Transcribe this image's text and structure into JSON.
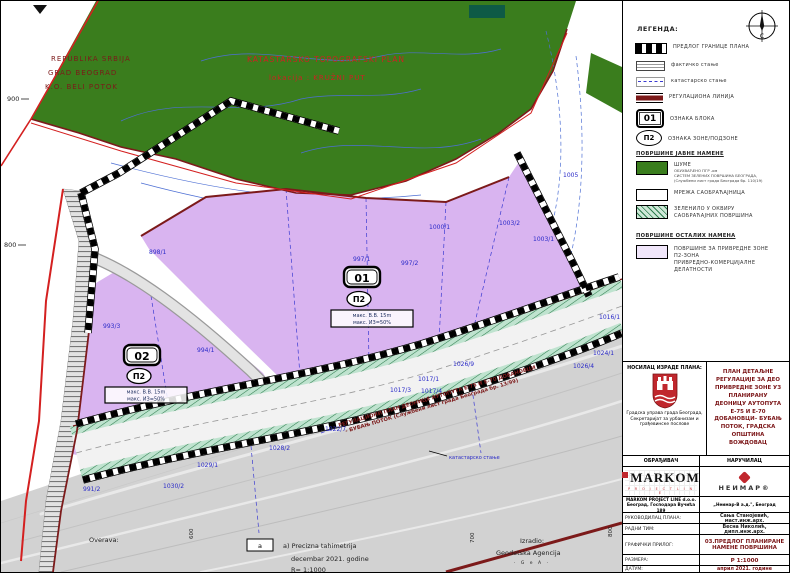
{
  "colors": {
    "forest_green": "#3a7d1d",
    "zone_purple": "#d9b4f0",
    "strip_green": "#6fbe8e",
    "regulation_maroon": "#7c1a1a",
    "boundary_red": "#d42020",
    "cadastral_blue": "#3b3bd1",
    "road_gray": "#d2d2d2"
  },
  "map": {
    "region": {
      "line1": "REPUBLIKA SRBIJA",
      "line2": "GRAD BEOGRAD",
      "line3": "K.O. BELI POTOK"
    },
    "title": {
      "line1": "KATASTARSKO TOPOGRAFSKI PLAN",
      "line2": "lokacija : KRUŽNI PUT"
    },
    "blocks": [
      {
        "id": "01",
        "zone": "П2",
        "param1": "макс. В.В. 15m",
        "param2": "макс. ИЗ=50%"
      },
      {
        "id": "02",
        "zone": "П2",
        "param1": "макс. В.В. 15m",
        "param2": "макс. ИЗ=50%"
      }
    ],
    "parcels": [
      "898/1",
      "997/1",
      "997/2",
      "1000/1",
      "1003/2",
      "1003/1",
      "1005",
      "1016/1",
      "1024/1",
      "1026/4",
      "1026/9",
      "1017/1",
      "1017/3",
      "1017/4",
      "1022/7",
      "1028/2",
      "1029/1",
      "1030/2",
      "993/3",
      "994/1",
      "991/2"
    ],
    "road_label_line1": "РЕГУЛАЦИОНИ ПЛАН ДЕОНИЦЕ АУТОПУТА Е-75 И Е-70 ДОБАНОВЦИ",
    "road_label_line2": "- БУБАЊ ПОТОК (Службени лист града Београда бр. 13/99)",
    "cadastral_note": "катастарско стање",
    "elevation_900": "900",
    "elevation_800": "800",
    "grid_600": "600",
    "grid_700": "700",
    "grid_800": "800",
    "overava": "Overava:",
    "izradio": "Izradio:",
    "agency": "Geodetska Agencija",
    "agency_sub": "· G e A ·",
    "survey_box": "a",
    "survey_line1": "a) Precizna tahimetrija",
    "survey_line2": "decembar 2021. godine",
    "survey_line3": "R= 1:1000"
  },
  "legend": {
    "title": "ЛЕГЕНДА:",
    "compass_letter": "С",
    "boundary": "ПРЕДЛОГ ГРАНИЦЕ ПЛАНА",
    "factual": "фактичко стање",
    "cadastral": "катастарско стање",
    "regulation": "РЕГУЛАЦИОНА ЛИНИЈА",
    "block_badge": "01",
    "block_label": "ОЗНАКА БЛОКА",
    "zone_badge": "П2",
    "zone_label": "ОЗНАКА ЗОНЕ/ПОДЗОНЕ",
    "section_public": "ПОВРШИНЕ ЈАВНЕ НАМЕНЕ",
    "forest": "ШУМЕ",
    "forest_note1": "ОБУХВАЋЕНО ПГР -ом",
    "forest_note2": "СИСТЕМ ЗЕЛЕНИХ ПОВРШИНА БЕОГРАДА,",
    "forest_note3": "(Службени лист града Београда бр. 110/19)",
    "roads": "МРЕЖА САОБРАЋАЈНИЦА",
    "greenery1": "ЗЕЛЕНИЛО У ОКВИРУ",
    "greenery2": "САОБРАЋАЈНИХ ПОВРШИНА",
    "section_other": "ПОВРШИНЕ ОСТАЛИХ НАМЕНА",
    "economic1": "ПОВРШИНЕ ЗА ПРИВРЕДНЕ ЗОНЕ",
    "economic2": "П2-ЗОНА",
    "economic3": "ПРИВРЕДНО-КОМЕРЦИЈАЛНЕ",
    "economic4": "ДЕЛАТНОСТИ"
  },
  "titleblock": {
    "holder_label": "НОСИЛАЦ ИЗРАДЕ ПЛАНА:",
    "holder_org1": "Градска управа града Београда,",
    "holder_org2": "Секретаријат за урбанизам и",
    "holder_org3": "грађевинске послове",
    "plan_title": "ПЛАН ДЕТАЉНЕ РЕГУЛАЦИЈЕ ЗА ДЕО ПРИВРЕДНЕ ЗОНЕ УЗ ПЛАНИРАНУ ДЕОНИЦУ АУТОПУТА Е-75 И Е-70 ДОБАНОВЦИ– БУБАЊ ПОТОК, ГРАДСКА ОПШТИНА ВОЖДОВАЦ",
    "obradjivac_label": "ОБРАЂИВАЧ",
    "narucilac_label": "НАРУЧИЛАЦ",
    "markom_name": "MARKOM",
    "markom_sub": "P R O J E C T   L I N E",
    "markom_addr1": "MARKOM PROJECT LINE d.o.o.",
    "markom_addr2": "Београд, Господара Вучића 189",
    "neimar_name": "НЕИМАР®",
    "neimar_addr": "„Неимар-В а.д.\", Београд",
    "rows": [
      {
        "label": "РУКОВОДИЛАЦ ПЛАНА:",
        "value": "Сања Станојевић, маст.инж.арх."
      },
      {
        "label": "РАДНИ ТИМ:",
        "value": "Весна Николић, дипл.инж.арх."
      },
      {
        "label": "ГРАФИЧКИ ПРИЛОГ:",
        "value": "03.ПРЕДЛОГ ПЛАНИРАНЕ НАМЕНЕ ПОВРШИНА"
      },
      {
        "label": "РАЗМЕРА:",
        "value": "Р 1:1000"
      },
      {
        "label": "ДАТУМ:",
        "value": "април 2021. године"
      }
    ]
  }
}
